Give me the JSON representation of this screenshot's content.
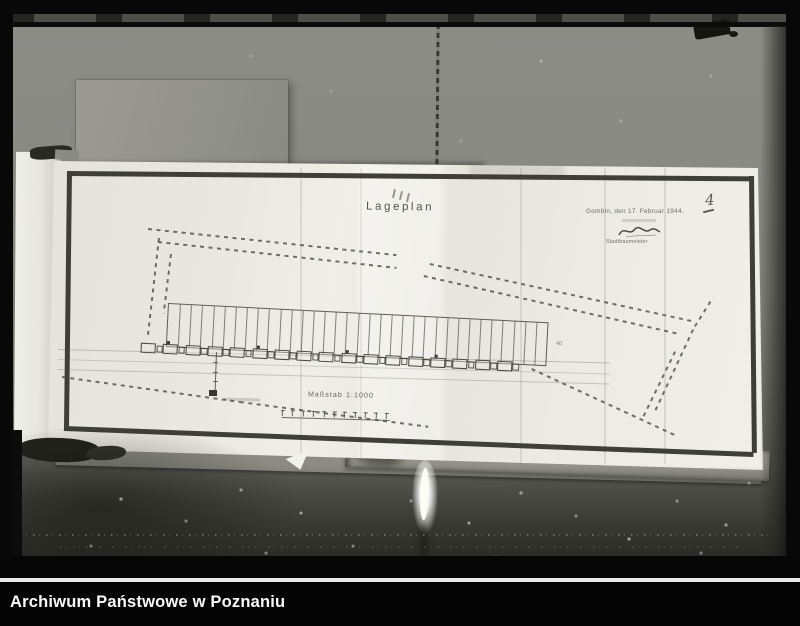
{
  "archive_caption": "Archiwum Państwowe w Poznaniu",
  "plan": {
    "title": "Lageplan",
    "date_line": "Gombin, den 17. Februar 1944.",
    "signatory_title": "Stadtbaumeister",
    "page_number": "4",
    "parcel_end_label": "40",
    "scale_label": "Maßstab 1:1000",
    "parcel_count": 34,
    "building_count": 17,
    "scale_tick_count": 11
  },
  "colors": {
    "photo_background": "#8d8d88",
    "paper": "#eceae3",
    "frame": "#3f3f3a",
    "ink": "#55554d",
    "caption_background": "#040404",
    "caption_text": "#fafafa"
  }
}
